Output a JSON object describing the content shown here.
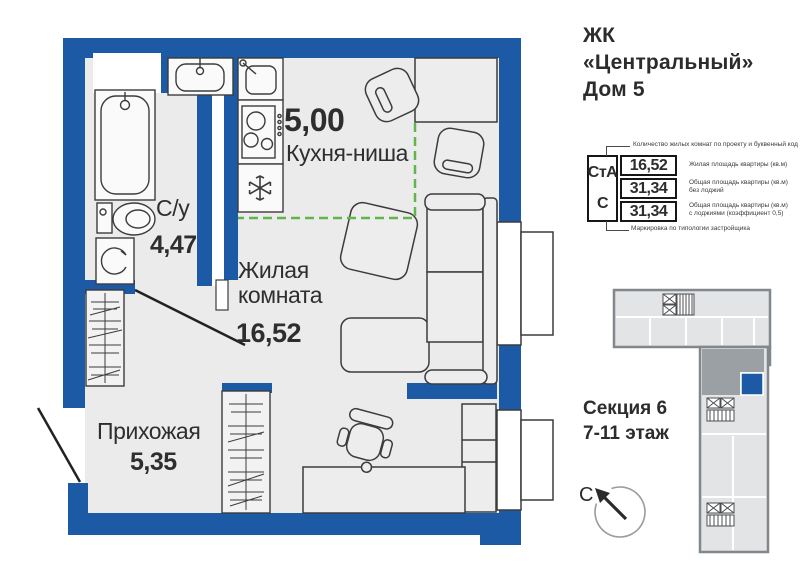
{
  "header": {
    "line1": "ЖК",
    "line2": "«Центральный»",
    "line3": "Дом 5"
  },
  "plan": {
    "rooms": {
      "kitchen": {
        "area": "5,00",
        "name": "Кухня-ниша"
      },
      "bathroom": {
        "name": "С/у",
        "area": "4,47"
      },
      "living": {
        "name": "Жилая комната",
        "area": "16,52"
      },
      "hall": {
        "name": "Прихожая",
        "area": "5,35"
      }
    },
    "fixtures": [
      "bathtub",
      "wash-basin",
      "toilet",
      "washing-machine",
      "kitchen-sink",
      "cooktop",
      "fridge-snowflake",
      "wardrobe",
      "dining-table",
      "armchair",
      "sofa",
      "desk",
      "office-chair",
      "window",
      "entrance-door"
    ],
    "kitchen_zone_outline": "dashed-green"
  },
  "card": {
    "type_code": "СтА",
    "type_letter": "С",
    "rows": [
      {
        "value": "16,52",
        "note": "Жилая площадь квартиры (кв.м)",
        "note2": ""
      },
      {
        "value": "31,34",
        "note": "Общая площадь квартиры (кв.м)",
        "note2": "без лоджий"
      },
      {
        "value": "31,34",
        "note": "Общая площадь квартиры (кв.м)",
        "note2": "с лоджиями (коэффициент 0,5)"
      }
    ],
    "ann_top": "Количество жилых комнат по проекту и буквенный код",
    "ann_bottom": "Маркировка по типологии застройщика"
  },
  "section": {
    "line1": "Секция 6",
    "line2": "7-11 этаж"
  },
  "compass": {
    "north_label": "С"
  },
  "colors": {
    "wall": "#1d5aa6",
    "floor": "#ebebec",
    "kitchen_zone": "#62b54a",
    "keyplan_light_unit": "#e3e4e6",
    "keyplan_dark_unit": "#9aa0a4",
    "keyplan_unit_highlight": "#1d5aa6"
  }
}
